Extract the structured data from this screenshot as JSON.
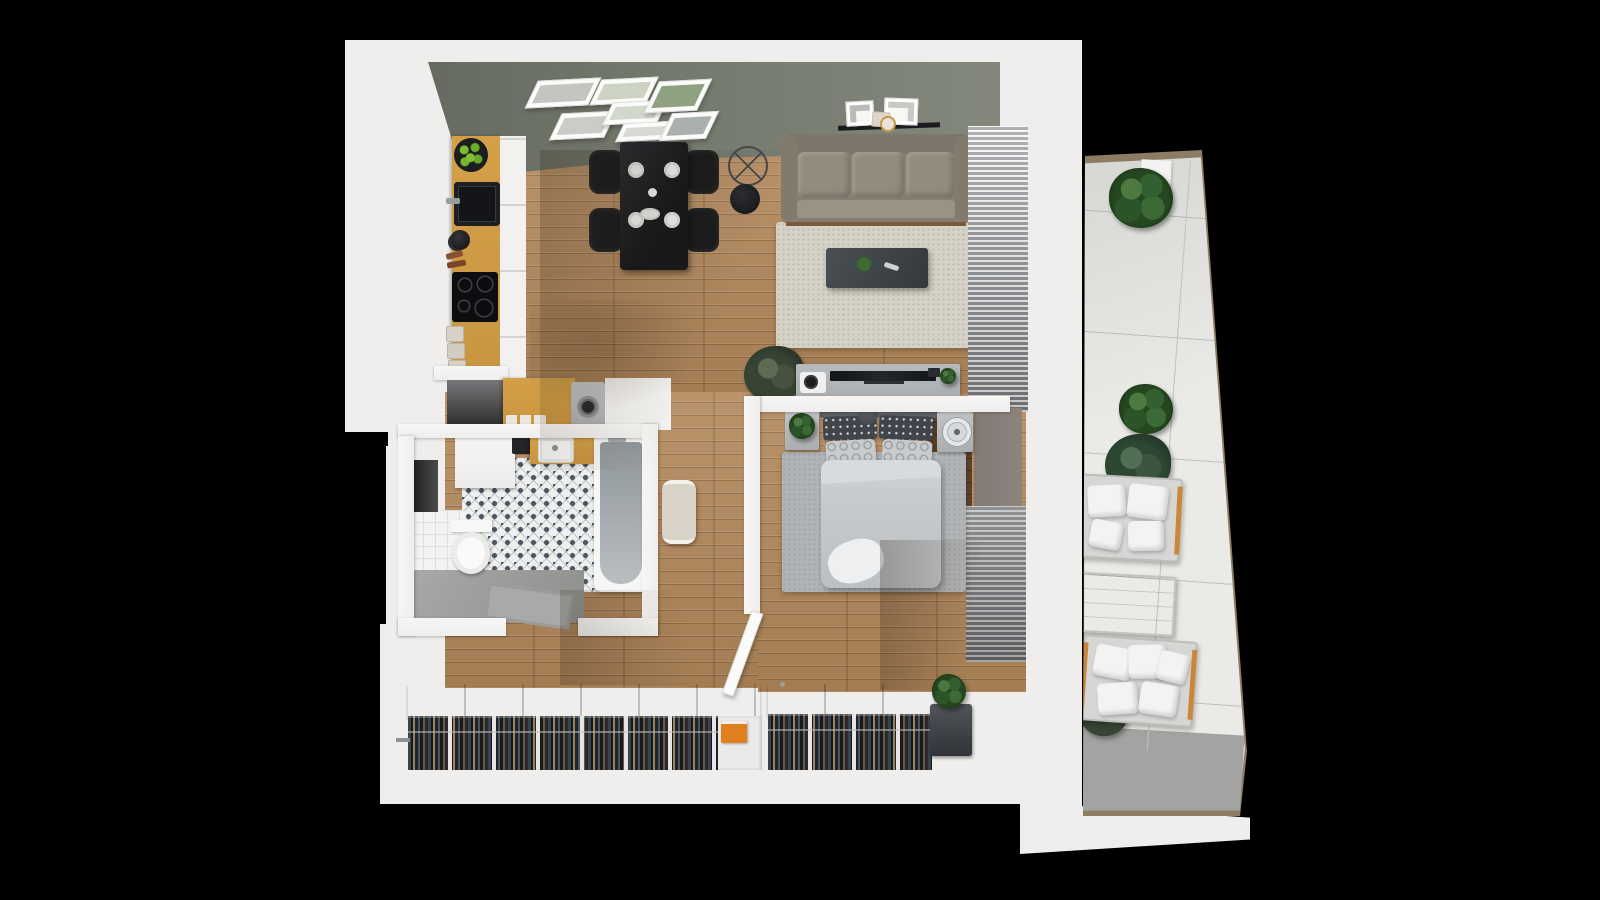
{
  "meta": {
    "type": "3d-apartment-floorplan-render",
    "background": "#000000"
  },
  "palette": {
    "wall": "#efeeec",
    "sage": "#757a6e",
    "wood": "#b2875a",
    "counterwood": "#c8953f",
    "black": "#17181a",
    "sofa": "#8a8376",
    "ruglight": "#d6d2c7",
    "rugbed": "#b1b4b6",
    "bedding": "#c7cacc",
    "pillowdark": "#41454b",
    "grayfurn": "#a9adb0",
    "taupe": "#8d857d",
    "clothesbg": "#101317",
    "orange": "#e0801c",
    "rail": "#8c7c63",
    "balconyfloor": "#eaeae7",
    "balconygray": "#a3a3a1",
    "tablewood": "#cd852a",
    "cushion": "#f3f3f1",
    "plant": "#2f5b33",
    "tile": "#eef0ef",
    "tilepattern": "#4d5560"
  },
  "rooms": {
    "kitchen": {
      "label": "Kitchen",
      "items": [
        "oak counter",
        "black sink",
        "cooktop with four burners",
        "fruit bowl with green apples",
        "kettle",
        "cutting boards",
        "white cabinet fronts",
        "storage jars"
      ]
    },
    "laundry_nook": {
      "label": "Laundry nook",
      "items": [
        "washing machine",
        "oak counter",
        "white cabinet",
        "open shelf niche",
        "cups"
      ]
    },
    "dining_area": {
      "label": "Dining area",
      "items": [
        "black dining table",
        "four black chairs",
        "four place settings",
        "orange flowers in vase",
        "serving platter",
        "arc floor lamp",
        "gallery wall with seven framed prints"
      ]
    },
    "living_room": {
      "label": "Living room",
      "items": [
        "three-seat fabric sofa",
        "wall shelf with frames and round mirror",
        "area rug",
        "dark coffee table with plant and remote",
        "TV sideboard",
        "turntable",
        "flat TV",
        "potted palm",
        "window blinds"
      ]
    },
    "bedroom": {
      "label": "Bedroom",
      "items": [
        "double bed with gray duvet",
        "patterned pillows",
        "two nightstands",
        "table fan",
        "potted plant",
        "area rug",
        "window blinds",
        "wardrobe with hanging clothes",
        "laundry hamper"
      ]
    },
    "bathroom": {
      "label": "Bathroom",
      "items": [
        "bathtub",
        "toilet",
        "vanity cabinet",
        "wood sink counter",
        "patterned tile floor",
        "white tile floor",
        "towel radiator",
        "door mat",
        "wall niche"
      ]
    },
    "hallway": {
      "label": "Hallway",
      "items": [
        "open wardrobe with hanging clothes",
        "orange storage box",
        "open bedroom door"
      ]
    },
    "balcony": {
      "label": "Balcony",
      "items": [
        "two cushioned benches",
        "wooden coffee table",
        "four potted plants",
        "brown railing",
        "glass balustrade line"
      ]
    }
  }
}
